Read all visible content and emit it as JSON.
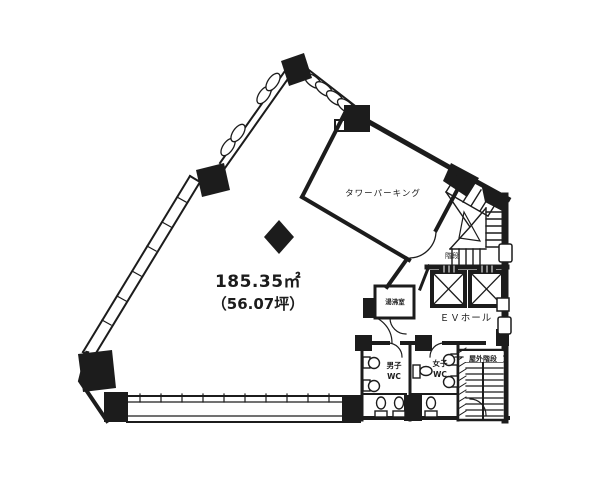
{
  "plan": {
    "area": {
      "m2": "185.35㎡",
      "tsubo": "（56.07坪）"
    },
    "rooms": {
      "tower_parking": "タワーパーキング",
      "stairs": "階段",
      "ev_hall": "ＥＶホール",
      "kitchenette": "湯沸室",
      "mens_wc": {
        "line1": "男子",
        "line2": "WC"
      },
      "womens_wc": {
        "line1": "女子",
        "line2": "WC"
      },
      "outdoor_stairs": "屋外階段"
    },
    "colors": {
      "line": "#1c1c1c",
      "background": "#ffffff"
    }
  }
}
